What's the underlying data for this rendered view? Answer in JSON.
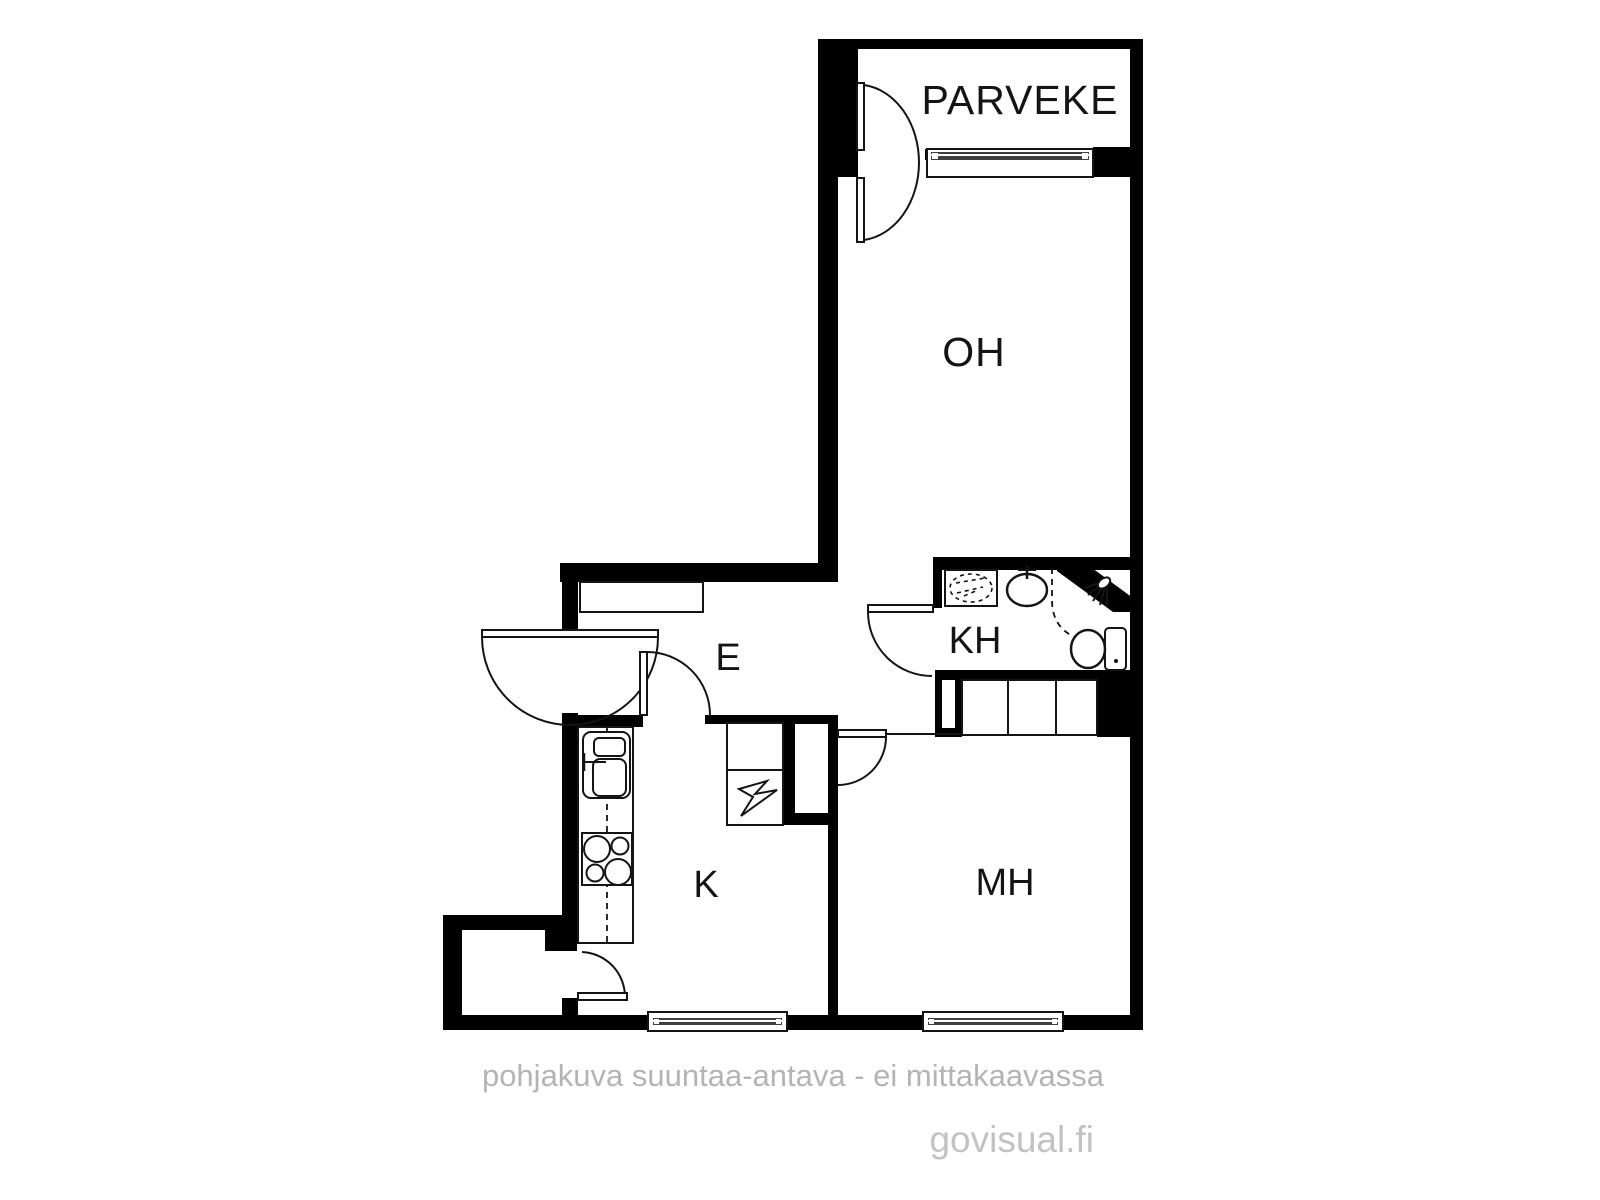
{
  "plan": {
    "rooms": {
      "balcony": {
        "label": "PARVEKE"
      },
      "living_room": {
        "label": "OH"
      },
      "bathroom": {
        "label": "KH"
      },
      "entry": {
        "label": "E"
      },
      "kitchen": {
        "label": "K"
      },
      "bedroom": {
        "label": "MH"
      }
    },
    "colors": {
      "wall": "#000000",
      "background": "#ffffff",
      "ink": "#141414",
      "glass": "#3f3f3f",
      "footer_text": "#b4b4b4",
      "watermark_text": "#c2c2c2"
    },
    "footer": {
      "disclaimer": "pohjakuva suuntaa-antava - ei mittakaavassa",
      "watermark": "govisual.fi"
    }
  }
}
